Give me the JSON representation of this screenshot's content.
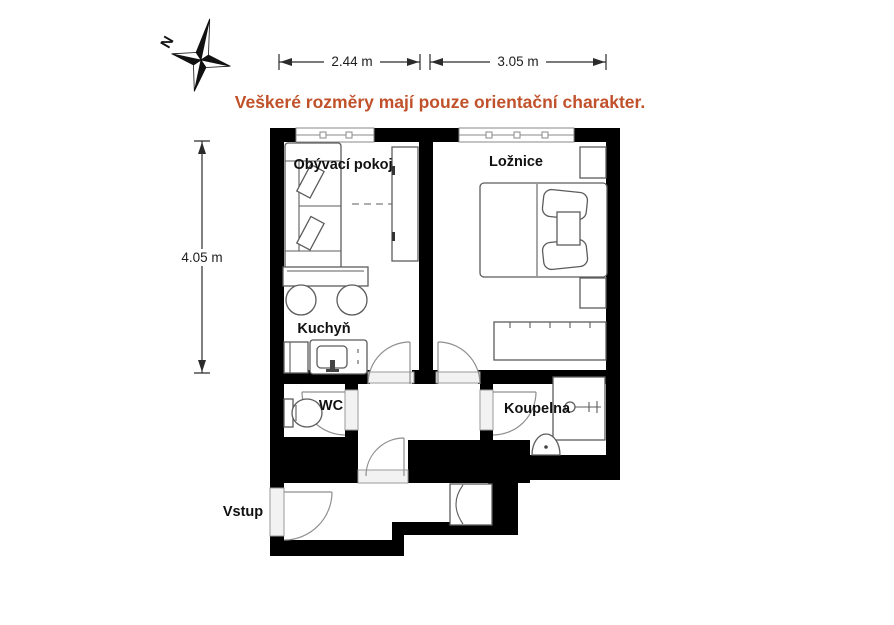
{
  "disclaimer": "Veškeré rozměry mají pouze orientační charakter.",
  "compass": {
    "north_label": "N"
  },
  "dimensions": {
    "living_width": "2.44 m",
    "bedroom_width": "3.05 m",
    "plan_height": "4.05 m"
  },
  "rooms": {
    "living": "Obývací pokoj",
    "bedroom": "Ložnice",
    "kitchen": "Kuchyň",
    "wc": "WC",
    "bathroom": "Koupelna",
    "entrance": "Vstup"
  },
  "colors": {
    "accent": "#c0512a",
    "wall": "#000000"
  }
}
